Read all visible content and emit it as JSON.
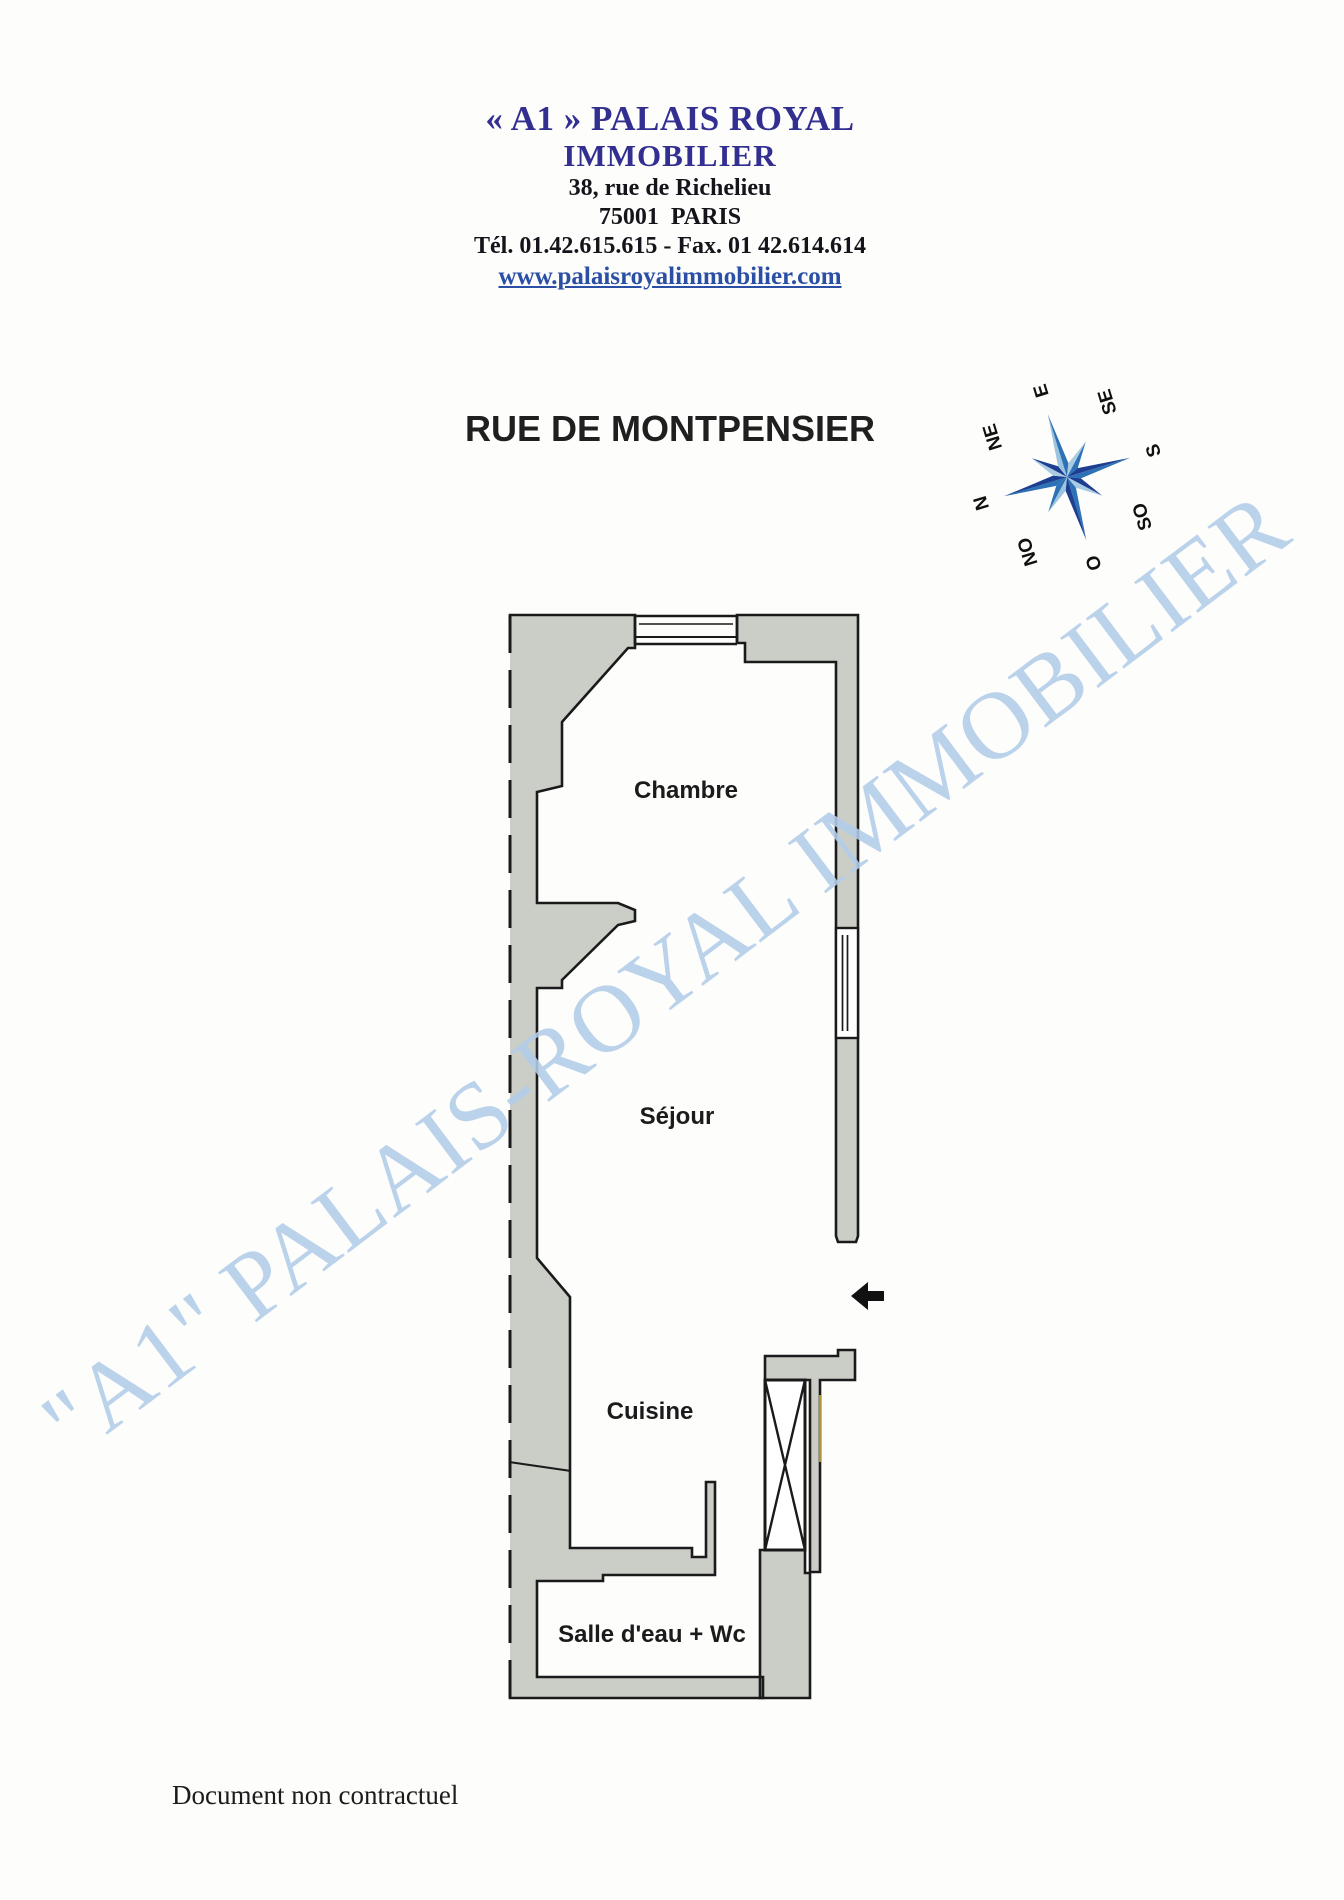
{
  "header": {
    "brand_line1": "« A1 » PALAIS ROYAL",
    "brand_line2": "IMMOBILIER",
    "address_line1": "38, rue de Richelieu",
    "address_line2": "75001  PARIS",
    "phone_fax_line": "Tél. 01.42.615.615 - Fax. 01 42.614.614",
    "website": "www.palaisroyalimmobilier.com",
    "brand_color": "#322f90",
    "website_color": "#2a4fa4"
  },
  "plan": {
    "title": "RUE DE MONTPENSIER",
    "rooms": [
      {
        "name": "Chambre"
      },
      {
        "name": "Séjour"
      },
      {
        "name": "Cuisine"
      },
      {
        "name": "Salle d'eau + Wc"
      }
    ],
    "wall_color": "#cbcec7",
    "outline_color": "#1a1a1a"
  },
  "compass": {
    "labels": [
      "N",
      "NE",
      "E",
      "SE",
      "S",
      "SO",
      "O",
      "NO"
    ],
    "colors": {
      "dark": "#1d3e91",
      "medium": "#2d71b6",
      "light": "#a9cbe3",
      "pale": "#9dc4de"
    }
  },
  "watermark": {
    "text": "\"A1\" PALAIS-ROYAL IMMOBILIER",
    "color": "#b3cde9"
  },
  "footer": {
    "note": "Document non contractuel"
  }
}
